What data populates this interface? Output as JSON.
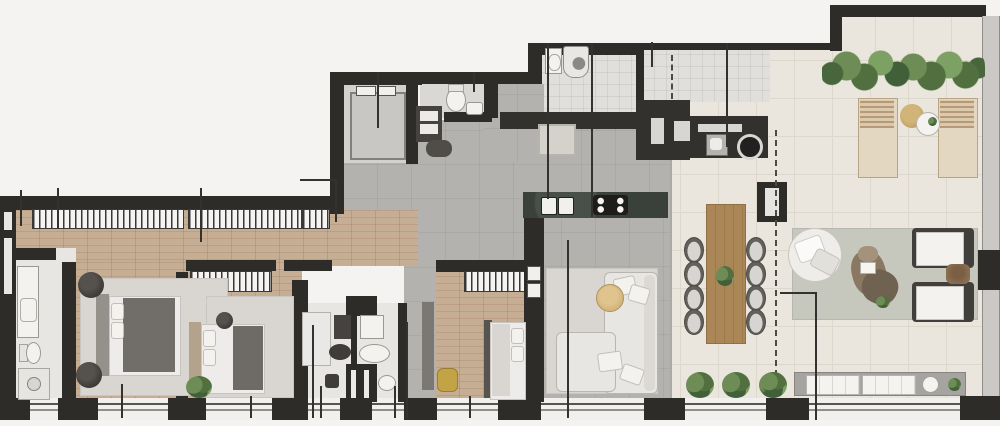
{
  "canvas": {
    "width": 1000,
    "height": 426
  },
  "palette": {
    "background": "#f4f3f1",
    "wall": "#2e2c29",
    "wood_floor": "#c6ae94",
    "gray_floor": "#b4b2af",
    "cream_floor": "#eae6dd",
    "marble_floor": "#e8e6e3",
    "tile_floor": "#e1dfdb",
    "glass_rail": "#cbc9c6",
    "counter_dark": "#33312e",
    "island_counter": "#39413a",
    "dining_wood": "#ab8758",
    "rug_light": "#d9d6d1",
    "rug_terrace": "#c6c7bd",
    "sofa_fill": "#e8e6e2",
    "bed_duvet_dark": "#716e69",
    "headboard_tan": "#b3a28c",
    "greenery_dark": "#41603a",
    "greenery_mid": "#52703f",
    "greenery_light": "#6d8c56",
    "accent_yellow": "#c2a345",
    "leader": "#34322f",
    "white_fixture": "#f3f2ef"
  },
  "plan": {
    "type": "apartment-floor-plan-top-view",
    "rooms": [
      {
        "id": "corridor",
        "floor": "wood",
        "features": [
          "built-in-wardrobes"
        ]
      },
      {
        "id": "master-suite",
        "floor": "wood",
        "furniture": [
          "double-bed",
          "rug",
          "round-pouf",
          "round-pouf"
        ]
      },
      {
        "id": "master-bathroom",
        "floor": "marble",
        "furniture": [
          "vanity",
          "toilet",
          "shower"
        ]
      },
      {
        "id": "bedroom-2",
        "floor": "wood",
        "furniture": [
          "wardrobe",
          "double-bed",
          "rug",
          "round-pouf",
          "plant"
        ]
      },
      {
        "id": "bedroom-3",
        "floor": "wood",
        "furniture": [
          "wardrobe",
          "single-bed",
          "yellow-pouf",
          "cabinet"
        ]
      },
      {
        "id": "bathroom-a",
        "floor": "marble",
        "furniture": [
          "dark-vanity",
          "dark-tub",
          "dark-toilet",
          "shower"
        ]
      },
      {
        "id": "bathroom-b",
        "floor": "marble",
        "furniture": [
          "white-vanity",
          "white-tub",
          "white-toilet"
        ]
      },
      {
        "id": "elevator",
        "features": [
          "elevator-car",
          "sliding-doors"
        ]
      },
      {
        "id": "lavabo-wc",
        "furniture": [
          "toilet",
          "small-sink",
          "shelf-unit",
          "mat"
        ]
      },
      {
        "id": "laundry",
        "floor": "tile",
        "furniture": [
          "laundry-sink",
          "washing-machine"
        ]
      },
      {
        "id": "service-room",
        "floor": "tile",
        "features": [
          "dashed-door"
        ]
      },
      {
        "id": "kitchen",
        "floor": "gray-porcelain",
        "furniture": [
          "island-with-two-sinks-and-cooktop",
          "cabinet-run",
          "fridge",
          "entry-rug"
        ]
      },
      {
        "id": "gourmet-counter",
        "furniture": [
          "dark-counter",
          "bbq-sink",
          "round-grill"
        ]
      },
      {
        "id": "living-room",
        "floor": "gray-porcelain",
        "furniture": [
          "tv-wall",
          "l-shaped-sofa",
          "rug",
          "round-side-table"
        ]
      },
      {
        "id": "dining-area",
        "floor": "cream-porcelain",
        "furniture": [
          "wood-table",
          "eight-chairs",
          "centerpiece-plant",
          "three-planter-shrubs"
        ]
      },
      {
        "id": "terrace",
        "floor": "cream-porcelain",
        "furniture": [
          "hedge-planter",
          "two-sun-loungers",
          "two-round-side-tables",
          "outdoor-rug",
          "round-daybed",
          "driftwood-coffee-table",
          "two-armchairs",
          "side-table",
          "bench-with-cushions",
          "tray",
          "plants"
        ]
      }
    ],
    "counts": {
      "bedrooms": 3,
      "bathrooms": 3,
      "dining_chairs": 8,
      "sun_loungers": 2,
      "terrace_armchairs": 2,
      "bottom_window_pillars": 10,
      "leader_lines": 18
    },
    "features": [
      "dashed-terrace-boundary",
      "glass-railing-right-edge",
      "continuous-window-wall-bottom",
      "leader-lines-without-labels"
    ]
  }
}
